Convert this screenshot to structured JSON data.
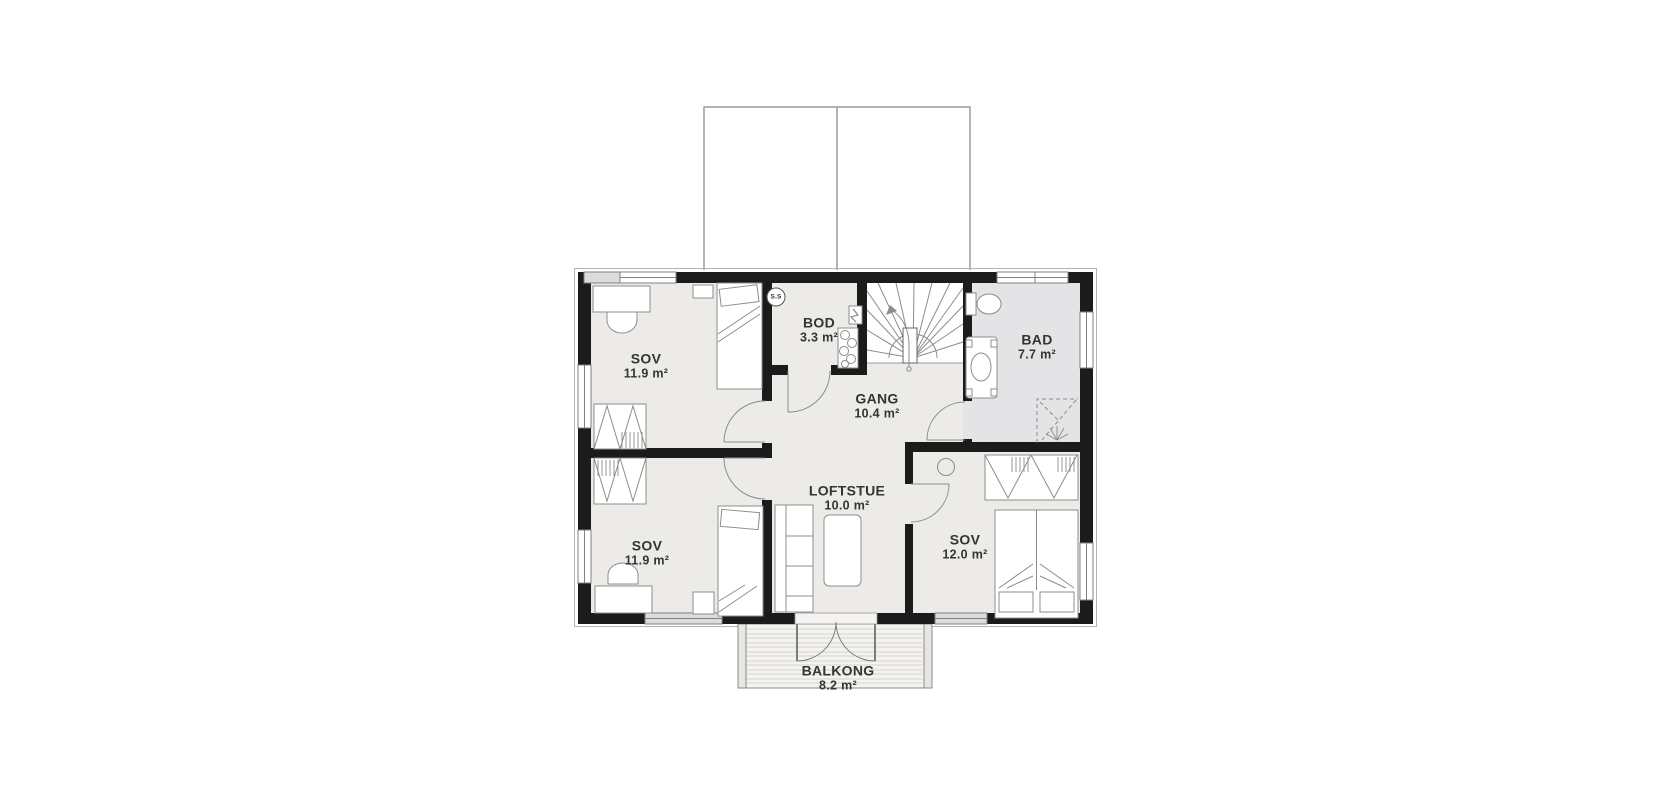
{
  "floorplan": {
    "rooms": [
      {
        "id": "sov-top-left",
        "name": "SOV",
        "area": "11.9 m²"
      },
      {
        "id": "sov-bottom-left",
        "name": "SOV",
        "area": "11.9 m²"
      },
      {
        "id": "bod",
        "name": "BOD",
        "area": "3.3 m²"
      },
      {
        "id": "gang",
        "name": "GANG",
        "area": "10.4 m²"
      },
      {
        "id": "bad",
        "name": "BAD",
        "area": "7.7 m²"
      },
      {
        "id": "loftstue",
        "name": "LOFTSTUE",
        "area": "10.0 m²"
      },
      {
        "id": "sov-right",
        "name": "SOV",
        "area": "12.0 m²"
      },
      {
        "id": "balkong",
        "name": "BALKONG",
        "area": "8.2 m²"
      }
    ],
    "markers": {
      "sensor_label": "S.S"
    },
    "colors": {
      "wall": "#1b1b1b",
      "floor": "#ecebe7",
      "bathroom_floor": "#e4e4e7",
      "line": "#8c8c8c",
      "deck": "#f4f3f1",
      "text": "#343434"
    }
  }
}
